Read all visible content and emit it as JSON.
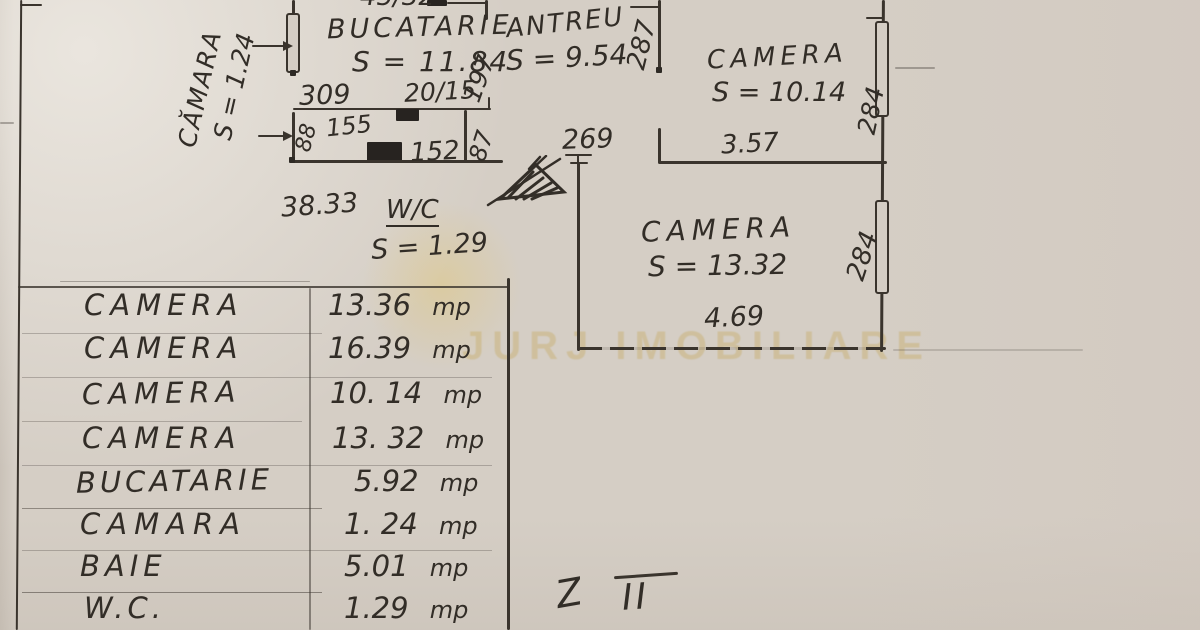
{
  "plan": {
    "partial_top": "45/32",
    "rooms": {
      "bucatarie": {
        "name": "BUCATARIE",
        "area": "S = 11.84"
      },
      "antreu": {
        "name": "ANTREU",
        "area": "S = 9.54"
      },
      "camera_top": {
        "name": "CAMERA",
        "area": "S = 10.14"
      },
      "camera_mid": {
        "name": "CAMERA",
        "area": "S = 13.32"
      },
      "camara": {
        "name": "CĂMARA",
        "area": "S = 1.24"
      },
      "wc": {
        "name": "W/C",
        "area": "S = 1.29"
      }
    },
    "dims": {
      "d309": "309",
      "d20_15": "20/15",
      "d197": "197",
      "d155": "155",
      "d88": "88",
      "d152": "152",
      "d87": "87",
      "d287": "287",
      "d269": "269",
      "d357": "3.57",
      "d284_top": "284",
      "d284_mid": "284",
      "d469": "4.69",
      "d3833": "38.33"
    },
    "note_z": "Z",
    "note_ii": "II"
  },
  "table": {
    "unit": "mp",
    "rows": [
      {
        "name": "CAMERA",
        "value": "13.36"
      },
      {
        "name": "CAMERA",
        "value": "16.39"
      },
      {
        "name": "CAMERA",
        "value": "10. 14"
      },
      {
        "name": "CAMERA",
        "value": "13. 32"
      },
      {
        "name": "BUCATARIE",
        "value": "5.92"
      },
      {
        "name": "CAMARA",
        "value": "1. 24"
      },
      {
        "name": "BAIE",
        "value": "5.01"
      },
      {
        "name": "W.C.",
        "value": "1.29"
      }
    ]
  },
  "watermark": {
    "text": "JURJ IMOBILIARE"
  },
  "colors": {
    "paper": "#d5cec5",
    "ink": "#3a342d",
    "handwriting": "#322d27",
    "gold": "#c6a85c"
  }
}
